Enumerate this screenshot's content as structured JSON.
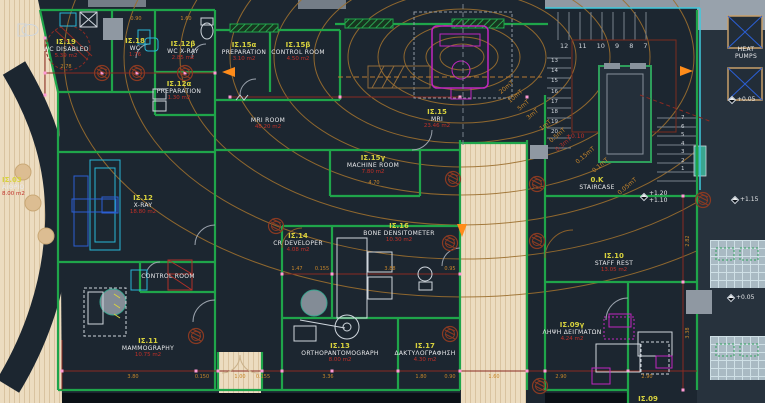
{
  "drawing": {
    "type": "architectural floor plan",
    "department": "radiology / imaging ground floor"
  },
  "rooms": [
    {
      "code": "ΙΣ.19",
      "name": "WC DISABLED",
      "area": "5.39 m2"
    },
    {
      "code": "ΙΣ.18",
      "name": "WC",
      "area": "1.76"
    },
    {
      "code": "ΙΣ.12β",
      "name": "WC X-RAY",
      "area": "2.85 m2"
    },
    {
      "code": "ΙΣ.12α",
      "name": "PREPARATION",
      "area": "1.30 m2"
    },
    {
      "code": "ΙΣ.15α",
      "name": "PREPARATION",
      "area": "3.10 m2"
    },
    {
      "code": "ΙΣ.15β",
      "name": "CONTROL ROOM",
      "area": "4.50 m2"
    },
    {
      "code": "",
      "name": "MRI ROOM",
      "area": "48.20 m2"
    },
    {
      "code": "ΙΣ.15",
      "name": "MRI",
      "area": "23.46 m2"
    },
    {
      "code": "ΙΣ.15γ",
      "name": "MACHINE ROOM",
      "area": "7.80 m2"
    },
    {
      "code": "ΙΣ.12",
      "name": "X-RAY",
      "area": "18.80 m2"
    },
    {
      "code": "ΙΣ.03",
      "name": "ΑΙΘΡΙΟ",
      "area": "8.00 m2"
    },
    {
      "code": "ΙΣ.14",
      "name": "CR DEVELOPER",
      "area": "4.08 m2"
    },
    {
      "code": "ΙΣ.16",
      "name": "BONE DENSITOMETER",
      "area": "10.30 m2"
    },
    {
      "code": "",
      "name": "CONTROL ROOM",
      "area": ""
    },
    {
      "code": "ΙΣ.11",
      "name": "MAMMOGRAPHY",
      "area": "10.75 m2"
    },
    {
      "code": "ΙΣ.13",
      "name": "ORTHOPANTOMOGRAPH",
      "area": "8.00 m2"
    },
    {
      "code": "ΙΣ.17",
      "name": "ΔΑΚΤΥΛΟΓΡΑΦΗΣΗ",
      "area": "4.30 m2"
    },
    {
      "code": "ΙΣ.10",
      "name": "STAFF REST",
      "area": "13.05 m2"
    },
    {
      "code": "ΙΣ.09γ",
      "name": "ΛΗΨΗ ΔΕΙΓΜΑΤΩΝ",
      "area": "4.24 m2"
    },
    {
      "code": "0.K",
      "name": "STAIRCASE",
      "area": ""
    },
    {
      "code": "",
      "name": "HEAT PUMPS",
      "area": ""
    },
    {
      "code": "ΙΣ.09",
      "name": "",
      "area": ""
    }
  ],
  "dims": [
    "2.78",
    "0.90",
    "1.60",
    "1.47",
    "3.88",
    "0.95",
    "4.70",
    "3.36",
    "1.80",
    "0.90",
    "1.60",
    "3.80",
    "0.150",
    "1.00",
    "2.90",
    "2.90",
    "2.82",
    "3.38",
    "0.155",
    "0.155"
  ],
  "contours": [
    "20mT",
    "10mT",
    "5mT",
    "3mT",
    "1mT",
    "0.5mT",
    "0.3mT",
    "0.15mT",
    "0.1mT",
    "0.05mT"
  ],
  "levels": [
    "+0.05",
    "+1.20",
    "+1.10",
    "+1.15",
    "+0.05",
    "+0.10"
  ],
  "stairs": {
    "upper": "12 11 10 9 8 7",
    "left": "13\n14\n15\n16\n17\n18\n19\n20",
    "right": "7\n6\n5\n4\n3\n2\n1"
  },
  "colors": {
    "background": "#1c2630",
    "wall_green": "#1fa54a",
    "dim_red": "#8a2a22",
    "contour_orange": "#9c6f2e",
    "code_yellow": "#d8d23e",
    "area_red": "#c03028",
    "mri_magenta": "#c026c0",
    "xray_cyan": "#29b6d6",
    "exterior_tan": "#ecdcc0",
    "marker_pink": "#ff9ad5",
    "arrow_orange": "#ff8c1a"
  }
}
